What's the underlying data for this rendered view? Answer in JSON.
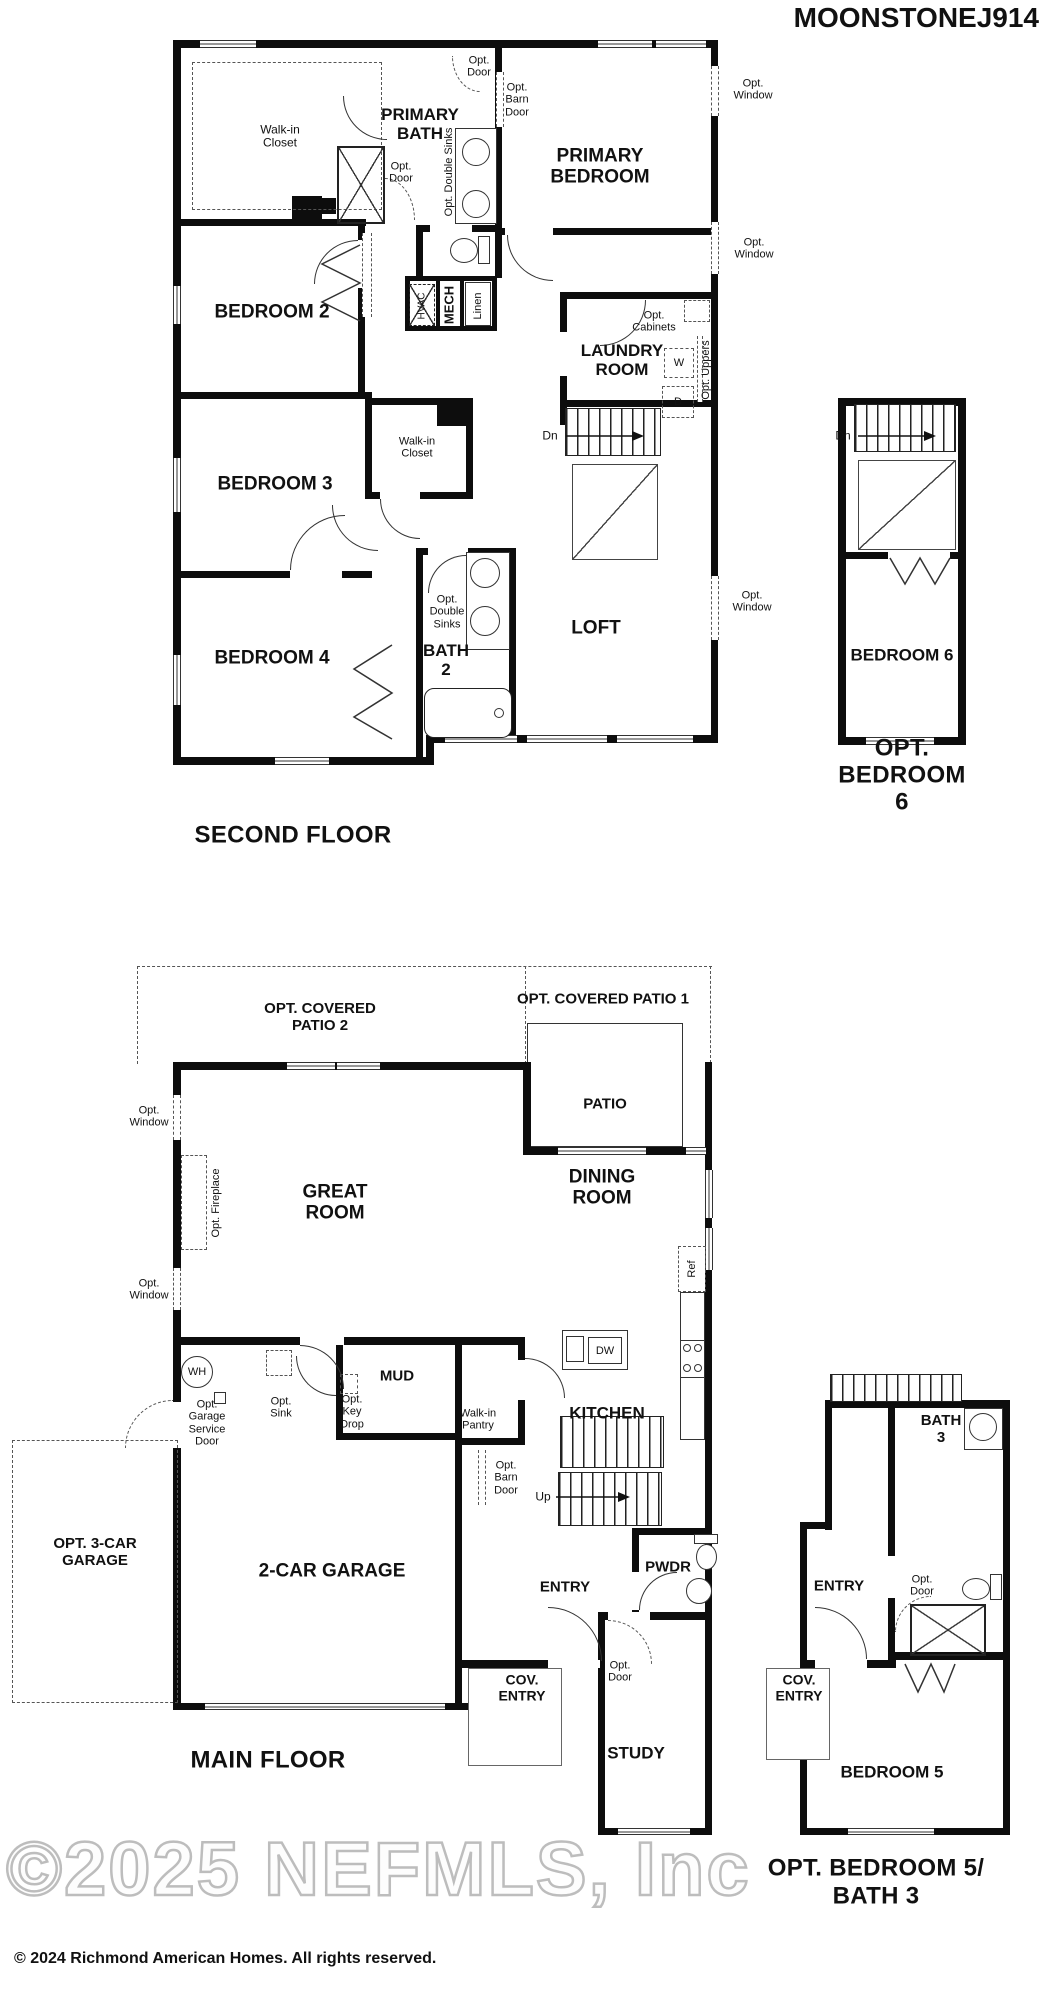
{
  "title": "MOONSTONEJ914",
  "captions": {
    "second_floor": "SECOND FLOOR",
    "opt_bedroom6": "OPT. BEDROOM 6",
    "main_floor": "MAIN FLOOR",
    "opt_bedroom5_line1": "OPT. BEDROOM 5/",
    "opt_bedroom5_line2": "BATH 3"
  },
  "rooms": {
    "walk_in_closet": "Walk-in\nCloset",
    "primary_bath": "PRIMARY\nBATH",
    "primary_bedroom": "PRIMARY\nBEDROOM",
    "bedroom2": "BEDROOM 2",
    "bedroom3": "BEDROOM 3",
    "bedroom4": "BEDROOM 4",
    "bedroom5": "BEDROOM 5",
    "bedroom6": "BEDROOM 6",
    "bath2": "BATH\n2",
    "bath3": "BATH\n3",
    "loft": "LOFT",
    "laundry": "LAUNDRY\nROOM",
    "mech": "MECH",
    "linen": "Linen",
    "great_room": "GREAT\nROOM",
    "dining": "DINING\nROOM",
    "kitchen": "KITCHEN",
    "mud": "MUD",
    "walk_in_pantry": "Walk-in\nPantry",
    "garage2": "2-CAR GARAGE",
    "opt_3car_garage": "OPT. 3-CAR\nGARAGE",
    "entry": "ENTRY",
    "pwdr": "PWDR",
    "cov_entry": "COV.\nENTRY",
    "study": "STUDY",
    "patio": "PATIO",
    "opt_covered_patio1": "OPT. COVERED PATIO 1",
    "opt_covered_patio2": "OPT. COVERED\nPATIO 2"
  },
  "annotations": {
    "opt_window": "Opt.\nWindow",
    "opt_door": "Opt.\nDoor",
    "opt_barn_door": "Opt.\nBarn\nDoor",
    "opt_double_sinks": "Opt. Double Sinks",
    "opt_double_sinks_stacked": "Opt.\nDouble\nSinks",
    "opt_cabinets": "Opt.\nCabinets",
    "opt_uppers": "Opt. Uppers",
    "opt_fireplace": "Opt. Fireplace",
    "opt_sink": "Opt.\nSink",
    "opt_key_drop": "Opt.\nKey\nDrop",
    "opt_garage_service_door": "Opt.\nGarage\nService\nDoor",
    "hvac": "HVAC",
    "dn": "Dn",
    "up": "Up"
  },
  "fixtures": {
    "washer": "W",
    "dryer": "D",
    "dishwasher": "DW",
    "water_heater": "WH",
    "refrigerator": "Ref"
  },
  "footer": {
    "watermark": "©2025 NEFMLS, Inc",
    "copyright": "© 2024 Richmond American Homes. All rights reserved."
  },
  "colors": {
    "wall": "#0d0d0d",
    "line": "#333333",
    "text": "#111111",
    "watermark": "#bdbdbd"
  }
}
